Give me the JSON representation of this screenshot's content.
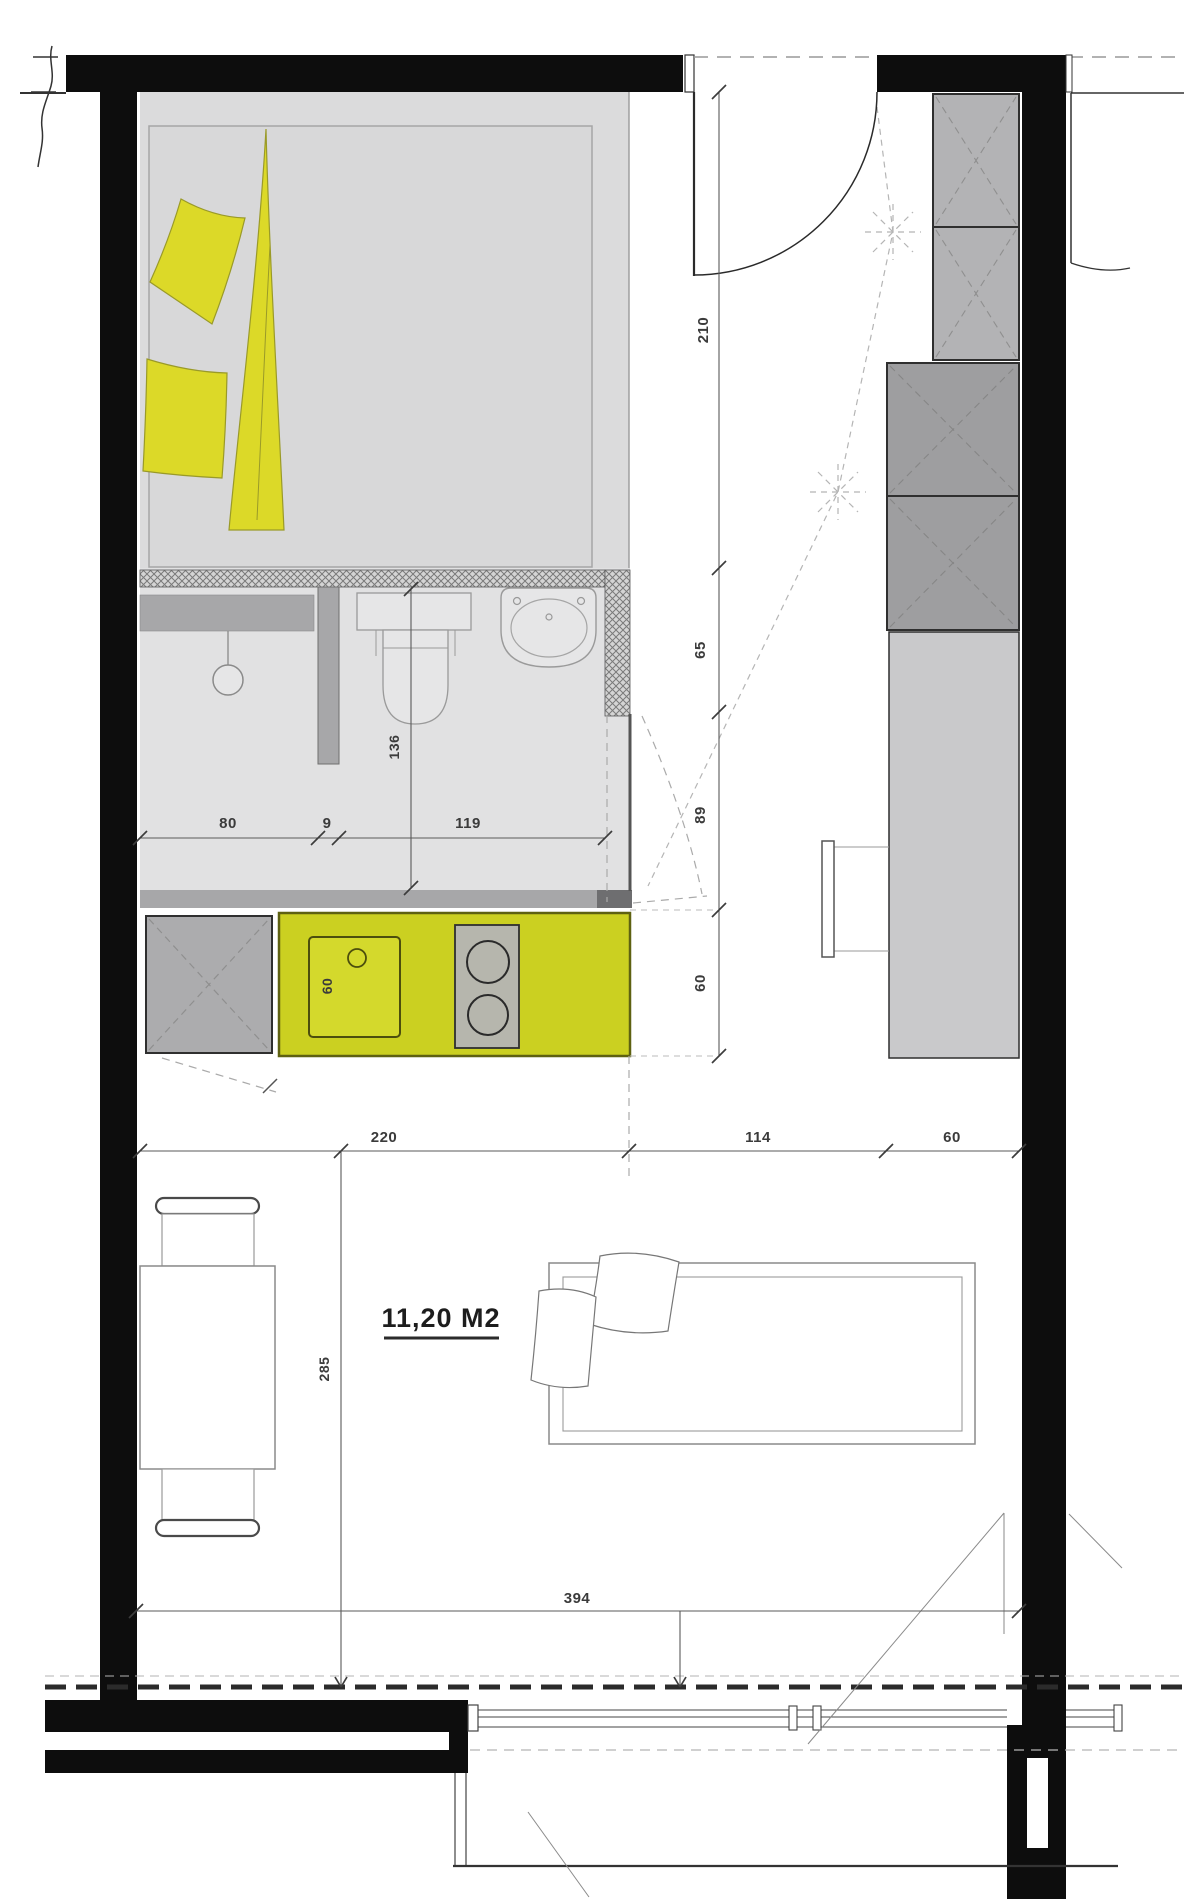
{
  "plan": {
    "type": "studio-apartment-floor-plan",
    "area": {
      "label": "11,20 M2"
    },
    "dims": {
      "entry_hall_depth": "210",
      "seg_65": "65",
      "seg_89": "89",
      "counter_depth": "60",
      "shower_width": "80",
      "partition_thickness": "9",
      "wc_width": "119",
      "wc_depth": "136",
      "kitchen_run": "220",
      "hall_width": "114",
      "wardrobe_depth": "60",
      "sink_unit_width": "60",
      "room_depth": "285",
      "room_width": "394"
    },
    "colors": {
      "wall_black": "#0d0d0d",
      "counter_yellow": "#cbd021",
      "textile_yellow": "#dcd928",
      "floor_gray": "#dbdbdc",
      "bath_floor_gray": "#e1e1e2",
      "cabinet_gray_dark": "#9e9ea0",
      "cabinet_gray_light": "#b3b3b5",
      "wardrobe_gray": "#c9c9cb"
    }
  }
}
